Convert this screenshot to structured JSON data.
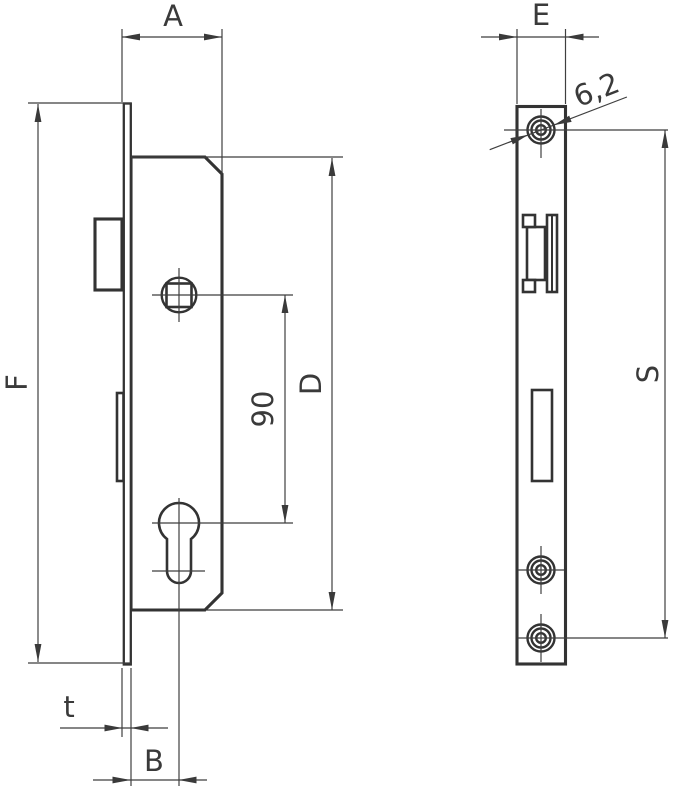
{
  "drawing": {
    "type": "technical-drawing",
    "subject": "mortise-lock-two-views",
    "background": "#ffffff",
    "line_color": "#333333",
    "dimensions": {
      "a_label": "A",
      "f_label": "F",
      "d_label": "D",
      "t_label": "t",
      "b_label": "B",
      "e_label": "E",
      "s_label": "S",
      "follower_to_cylinder": "90",
      "screw_hole_diameter": "6,2"
    }
  }
}
